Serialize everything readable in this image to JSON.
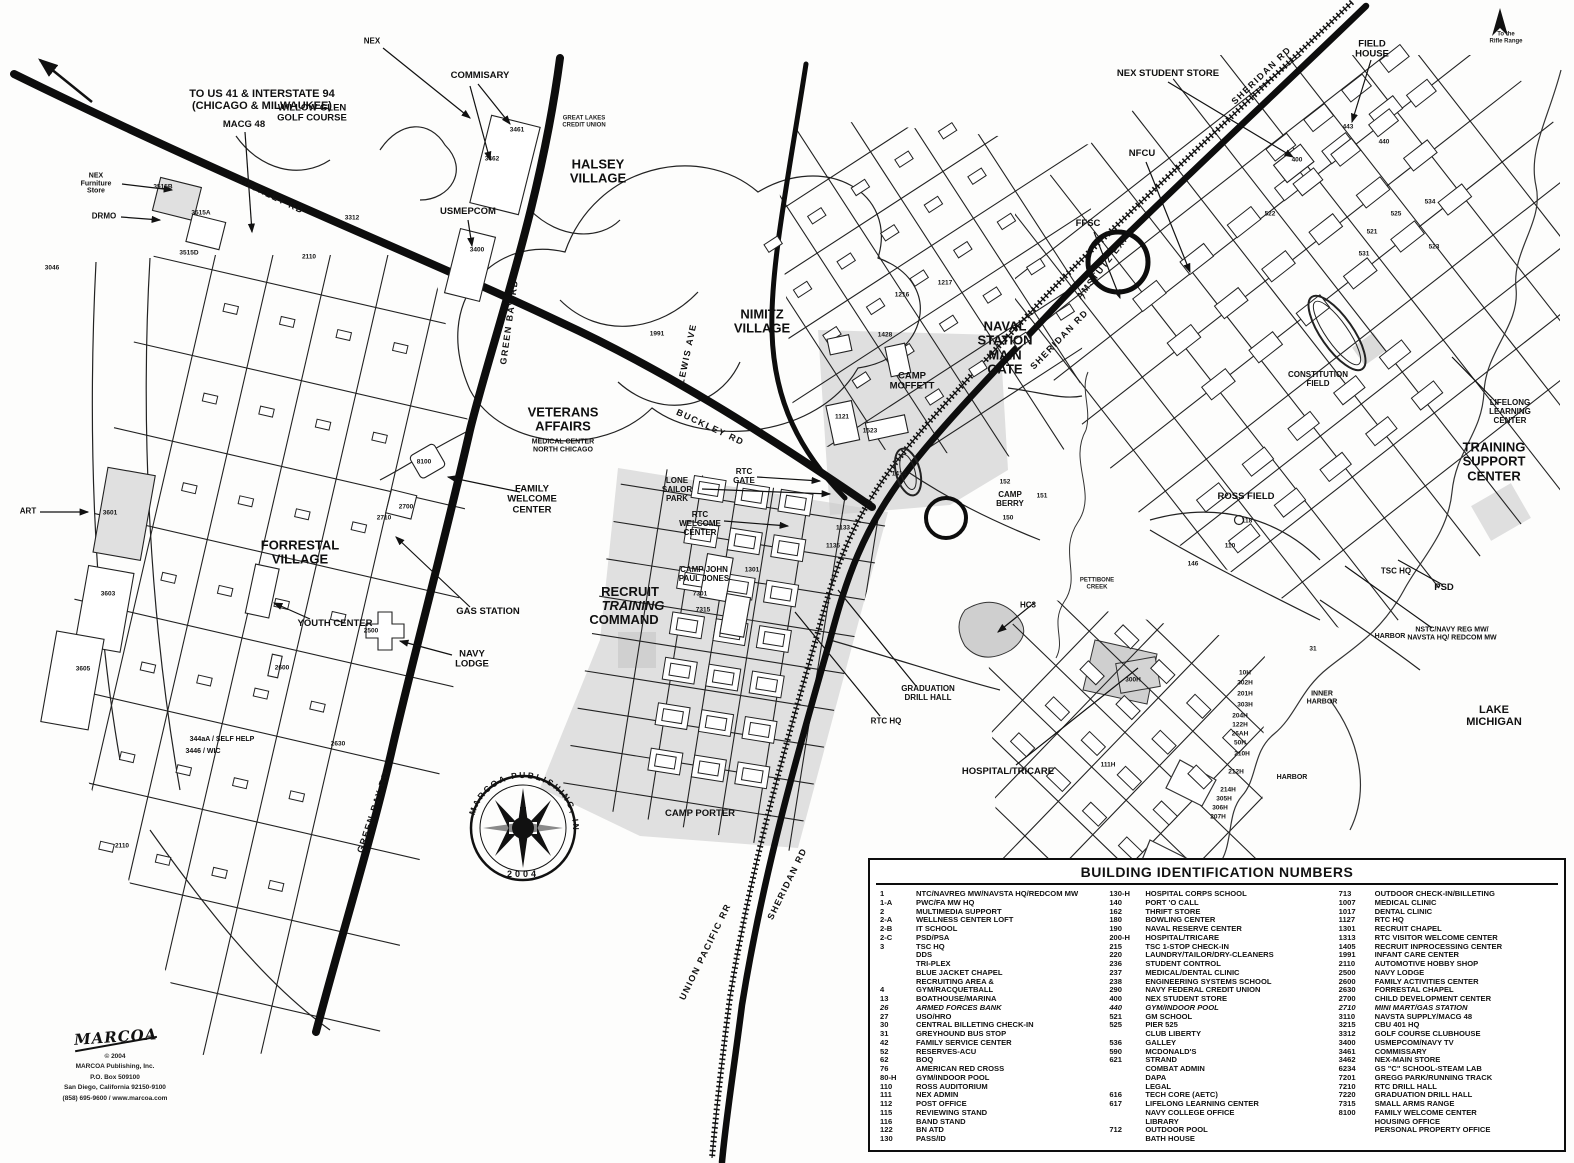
{
  "legend": {
    "title": "BUILDING IDENTIFICATION NUMBERS",
    "columns": [
      [
        {
          "n": "1",
          "t": "NTC/NAVREG MW/NAVSTA HQ/REDCOM MW"
        },
        {
          "n": "1-A",
          "t": "PWC/FA MW HQ"
        },
        {
          "n": "2",
          "t": "MULTIMEDIA SUPPORT"
        },
        {
          "n": "2-A",
          "t": "WELLNESS CENTER LOFT"
        },
        {
          "n": "2-B",
          "t": "IT SCHOOL"
        },
        {
          "n": "2-C",
          "t": "PSD/PSA"
        },
        {
          "n": "3",
          "t": "TSC HQ"
        },
        {
          "n": "",
          "t": "DDS"
        },
        {
          "n": "",
          "t": "TRI-PLEX"
        },
        {
          "n": "",
          "t": "BLUE JACKET CHAPEL"
        },
        {
          "n": "",
          "t": "RECRUITING AREA &"
        },
        {
          "n": "4",
          "t": "GYM/RACQUETBALL"
        },
        {
          "n": "13",
          "t": "BOATHOUSE/MARINA"
        },
        {
          "n": "26",
          "t": "ARMED FORCES BANK",
          "i": true
        },
        {
          "n": "27",
          "t": "USO/HRO"
        },
        {
          "n": "30",
          "t": "CENTRAL BILLETING CHECK-IN"
        },
        {
          "n": "31",
          "t": "GREYHOUND BUS STOP"
        },
        {
          "n": "42",
          "t": "FAMILY SERVICE CENTER"
        },
        {
          "n": "52",
          "t": "RESERVES-ACU"
        },
        {
          "n": "62",
          "t": "BOQ"
        },
        {
          "n": "76",
          "t": "AMERICAN RED CROSS"
        },
        {
          "n": "80-H",
          "t": "GYM/INDOOR POOL"
        },
        {
          "n": "110",
          "t": "ROSS AUDITORIUM"
        },
        {
          "n": "111",
          "t": "NEX ADMIN"
        },
        {
          "n": "112",
          "t": "POST OFFICE"
        },
        {
          "n": "115",
          "t": "REVIEWING STAND"
        },
        {
          "n": "116",
          "t": "BAND STAND"
        },
        {
          "n": "122",
          "t": "BN  ATD"
        },
        {
          "n": "130",
          "t": "PASS/ID"
        }
      ],
      [
        {
          "n": "130-H",
          "t": "HOSPITAL CORPS SCHOOL"
        },
        {
          "n": "140",
          "t": "PORT 'O CALL"
        },
        {
          "n": "162",
          "t": "THRIFT STORE"
        },
        {
          "n": "180",
          "t": "BOWLING CENTER"
        },
        {
          "n": "190",
          "t": "NAVAL RESERVE CENTER"
        },
        {
          "n": "200-H",
          "t": "HOSPITAL/TRICARE"
        },
        {
          "n": "215",
          "t": "TSC 1-STOP CHECK-IN"
        },
        {
          "n": "220",
          "t": "LAUNDRY/TAILOR/DRY-CLEANERS"
        },
        {
          "n": "236",
          "t": "STUDENT CONTROL"
        },
        {
          "n": "237",
          "t": "MEDICAL/DENTAL CLINIC"
        },
        {
          "n": "238",
          "t": "ENGINEERING SYSTEMS SCHOOL"
        },
        {
          "n": "290",
          "t": "NAVY FEDERAL CREDIT UNION"
        },
        {
          "n": "400",
          "t": "NEX STUDENT STORE"
        },
        {
          "n": "440",
          "t": "GYM/INDOOR POOL",
          "i": true
        },
        {
          "n": "521",
          "t": "GM SCHOOL"
        },
        {
          "n": "525",
          "t": "PIER 525"
        },
        {
          "n": "",
          "t": "CLUB LIBERTY"
        },
        {
          "n": "536",
          "t": "GALLEY"
        },
        {
          "n": "590",
          "t": "MCDONALD'S"
        },
        {
          "n": "621",
          "t": "STRAND"
        },
        {
          "n": "",
          "t": "COMBAT ADMIN"
        },
        {
          "n": "",
          "t": "DAPA"
        },
        {
          "n": "",
          "t": "LEGAL"
        },
        {
          "n": "616",
          "t": "TECH CORE (AETC)"
        },
        {
          "n": "617",
          "t": "LIFELONG LEARNING CENTER"
        },
        {
          "n": "",
          "t": "NAVY COLLEGE OFFICE"
        },
        {
          "n": "",
          "t": "LIBRARY"
        },
        {
          "n": "712",
          "t": "OUTDOOR POOL"
        },
        {
          "n": "",
          "t": "BATH HOUSE"
        }
      ],
      [
        {
          "n": "713",
          "t": "OUTDOOR CHECK-IN/BILLETING"
        },
        {
          "n": "1007",
          "t": "MEDICAL CLINIC"
        },
        {
          "n": "1017",
          "t": "DENTAL CLINIC"
        },
        {
          "n": "1127",
          "t": "RTC HQ"
        },
        {
          "n": "1301",
          "t": "RECRUIT CHAPEL"
        },
        {
          "n": "1313",
          "t": "RTC VISITOR WELCOME CENTER"
        },
        {
          "n": "1405",
          "t": "RECRUIT INPROCESSING CENTER"
        },
        {
          "n": "1991",
          "t": "INFANT CARE CENTER"
        },
        {
          "n": "2110",
          "t": "AUTOMOTIVE HOBBY SHOP"
        },
        {
          "n": "2500",
          "t": "NAVY LODGE"
        },
        {
          "n": "2600",
          "t": "FAMILY ACTIVITIES CENTER"
        },
        {
          "n": "2630",
          "t": "FORRESTAL CHAPEL"
        },
        {
          "n": "2700",
          "t": "CHILD DEVELOPMENT CENTER"
        },
        {
          "n": "2710",
          "t": "MINI MART/GAS STATION",
          "i": true
        },
        {
          "n": "3110",
          "t": "NAVSTA SUPPLY/MACG 48"
        },
        {
          "n": "3215",
          "t": "CBU 401 HQ"
        },
        {
          "n": "3312",
          "t": "GOLF COURSE CLUBHOUSE"
        },
        {
          "n": "3400",
          "t": "USMEPCOM/NAVY TV"
        },
        {
          "n": "3461",
          "t": "COMMISSARY"
        },
        {
          "n": "3462",
          "t": "NEX-MAIN STORE"
        },
        {
          "n": "6234",
          "t": "GS \"C\" SCHOOL-STEAM LAB"
        },
        {
          "n": "7201",
          "t": "GREGG PARK/RUNNING TRACK"
        },
        {
          "n": "7210",
          "t": "RTC DRILL HALL"
        },
        {
          "n": "7220",
          "t": "GRADUATION DRILL HALL"
        },
        {
          "n": "7315",
          "t": "SMALL ARMS RANGE"
        },
        {
          "n": "8100",
          "t": "FAMILY WELCOME CENTER"
        },
        {
          "n": "",
          "t": "HOUSING OFFICE"
        },
        {
          "n": "",
          "t": "PERSONAL PROPERTY OFFICE"
        }
      ]
    ]
  },
  "map": {
    "labels": [
      {
        "t": "TO US 41 & INTERSTATE 94\n(CHICAGO & MILWAUKEE)",
        "x": 262,
        "y": 100,
        "s": "lg"
      },
      {
        "t": "NEX",
        "x": 372,
        "y": 42,
        "s": "sm"
      },
      {
        "t": "COMMISARY",
        "x": 480,
        "y": 76,
        "s": "md"
      },
      {
        "t": "WILLOW GLEN\nGOLF COURSE",
        "x": 312,
        "y": 114,
        "s": "md"
      },
      {
        "t": "MACG 48",
        "x": 244,
        "y": 125,
        "s": "md"
      },
      {
        "t": "NEX\nFurniture\nStore",
        "x": 96,
        "y": 184,
        "s": "xs"
      },
      {
        "t": "DRMO",
        "x": 104,
        "y": 217,
        "s": "sm"
      },
      {
        "t": "HALSEY\nVILLAGE",
        "x": 598,
        "y": 172,
        "s": "xl"
      },
      {
        "t": "GREAT LAKES\nCREDIT UNION",
        "x": 584,
        "y": 122,
        "s": "xxs"
      },
      {
        "t": "USMEPCOM",
        "x": 468,
        "y": 212,
        "s": "md"
      },
      {
        "t": "NIMITZ\nVILLAGE",
        "x": 762,
        "y": 322,
        "s": "xl"
      },
      {
        "t": "VETERANS\nAFFAIRS",
        "x": 563,
        "y": 420,
        "s": "xl"
      },
      {
        "t": "MEDICAL CENTER\nNORTH CHICAGO",
        "x": 563,
        "y": 446,
        "s": "xs"
      },
      {
        "t": "CAMP\nMOFFETT",
        "x": 912,
        "y": 382,
        "s": "md"
      },
      {
        "t": "NAVAL\nSTATION\nMAIN\nGATE",
        "x": 1005,
        "y": 348,
        "s": "xl"
      },
      {
        "t": "NEX STUDENT STORE",
        "x": 1168,
        "y": 74,
        "s": "md"
      },
      {
        "t": "FIELD\nHOUSE",
        "x": 1372,
        "y": 50,
        "s": "md"
      },
      {
        "t": "NFCU",
        "x": 1142,
        "y": 154,
        "s": "md"
      },
      {
        "t": "FFSC",
        "x": 1088,
        "y": 224,
        "s": "md"
      },
      {
        "t": "AMSTUTZ EXPY",
        "x": 1106,
        "y": 264,
        "s": "road",
        "r": -52
      },
      {
        "t": "SHERIDAN RD",
        "x": 1262,
        "y": 76,
        "s": "road",
        "r": -44
      },
      {
        "t": "SHERIDAN RD",
        "x": 1060,
        "y": 340,
        "s": "road",
        "r": -46
      },
      {
        "t": "CONSTITUTION\nFIELD",
        "x": 1318,
        "y": 380,
        "s": "sm"
      },
      {
        "t": "TRAINING\nSUPPORT CENTER",
        "x": 1494,
        "y": 462,
        "s": "xl"
      },
      {
        "t": "LIFELONG\nLEARNING CENTER",
        "x": 1510,
        "y": 412,
        "s": "sm"
      },
      {
        "t": "TSC HQ",
        "x": 1396,
        "y": 572,
        "s": "sm"
      },
      {
        "t": "PSD",
        "x": 1444,
        "y": 588,
        "s": "md"
      },
      {
        "t": "NSTC/NAVY REG MW/\nNAVSTA HQ/ REDCOM MW",
        "x": 1452,
        "y": 634,
        "s": "xs"
      },
      {
        "t": "HARBOR",
        "x": 1390,
        "y": 637,
        "s": "xs"
      },
      {
        "t": "INNER\nHARBOR",
        "x": 1322,
        "y": 698,
        "s": "xs"
      },
      {
        "t": "HARBOR",
        "x": 1292,
        "y": 778,
        "s": "xs"
      },
      {
        "t": "LAKE MICHIGAN",
        "x": 1494,
        "y": 716,
        "s": "lg"
      },
      {
        "t": "PETTIBONE\nCREEK",
        "x": 1097,
        "y": 584,
        "s": "xxs"
      },
      {
        "t": "HC3",
        "x": 1028,
        "y": 606,
        "s": "sm"
      },
      {
        "t": "HOSPITAL/TRICARE",
        "x": 1008,
        "y": 772,
        "s": "md"
      },
      {
        "t": "CAMP\nBERRY",
        "x": 1010,
        "y": 500,
        "s": "sm"
      },
      {
        "t": "ROSS FIELD",
        "x": 1246,
        "y": 497,
        "s": "md"
      },
      {
        "t": "RTC\nGATE",
        "x": 744,
        "y": 477,
        "s": "sm"
      },
      {
        "t": "LONE\nSAILOR\nPARK",
        "x": 677,
        "y": 490,
        "s": "sm"
      },
      {
        "t": "RTC\nWELCOME\nCENTER",
        "x": 700,
        "y": 524,
        "s": "sm"
      },
      {
        "t": "CAMP JOHN\nPAUL JONES",
        "x": 704,
        "y": 575,
        "s": "sm"
      },
      {
        "t": "RECRUIT",
        "x": 630,
        "y": 592,
        "s": "xl"
      },
      {
        "t": "TRAINING",
        "x": 633,
        "y": 606,
        "s": "xl",
        "i": true
      },
      {
        "t": "COMMAND",
        "x": 624,
        "y": 620,
        "s": "xl"
      },
      {
        "t": "GRADUATION\nDRILL HALL",
        "x": 928,
        "y": 694,
        "s": "sm"
      },
      {
        "t": "RTC HQ",
        "x": 886,
        "y": 722,
        "s": "sm"
      },
      {
        "t": "CAMP PORTER",
        "x": 700,
        "y": 814,
        "s": "md"
      },
      {
        "t": "UNION PACIFIC RR",
        "x": 706,
        "y": 952,
        "s": "road",
        "r": -64
      },
      {
        "t": "SHERIDAN RD",
        "x": 788,
        "y": 884,
        "s": "road",
        "r": -64
      },
      {
        "t": "GREEN BAY\nRD",
        "x": 510,
        "y": 322,
        "s": "road",
        "r": -82
      },
      {
        "t": "GREEN BAY RD",
        "x": 374,
        "y": 812,
        "s": "road",
        "r": -72
      },
      {
        "t": "BUCKLEY RD",
        "x": 270,
        "y": 196,
        "s": "road",
        "r": 26
      },
      {
        "t": "BUCKLEY RD",
        "x": 710,
        "y": 428,
        "s": "road",
        "r": 25
      },
      {
        "t": "LEWIS AVE",
        "x": 688,
        "y": 354,
        "s": "road",
        "r": -78
      },
      {
        "t": "FORRESTAL\nVILLAGE",
        "x": 300,
        "y": 553,
        "s": "xl"
      },
      {
        "t": "YOUTH CENTER",
        "x": 335,
        "y": 624,
        "s": "md"
      },
      {
        "t": "GAS STATION",
        "x": 488,
        "y": 612,
        "s": "md"
      },
      {
        "t": "NAVY\nLODGE",
        "x": 472,
        "y": 660,
        "s": "md"
      },
      {
        "t": "FAMILY\nWELCOME\nCENTER",
        "x": 532,
        "y": 500,
        "s": "md"
      },
      {
        "t": "ART",
        "x": 28,
        "y": 512,
        "s": "sm"
      },
      {
        "t": "344aA / SELF HELP",
        "x": 222,
        "y": 740,
        "s": "xs"
      },
      {
        "t": "3446 / WIC",
        "x": 203,
        "y": 752,
        "s": "xs"
      },
      {
        "t": "To the\nRifle Range",
        "x": 1506,
        "y": 38,
        "s": "xxs"
      }
    ],
    "numbers": [
      {
        "t": "3515B",
        "x": 163,
        "y": 187
      },
      {
        "t": "3515A",
        "x": 201,
        "y": 213
      },
      {
        "t": "3515D",
        "x": 189,
        "y": 253
      },
      {
        "t": "3046",
        "x": 52,
        "y": 268
      },
      {
        "t": "2110",
        "x": 309,
        "y": 257
      },
      {
        "t": "3312",
        "x": 352,
        "y": 218
      },
      {
        "t": "3461",
        "x": 517,
        "y": 130
      },
      {
        "t": "3462",
        "x": 492,
        "y": 159
      },
      {
        "t": "3400",
        "x": 477,
        "y": 250
      },
      {
        "t": "1991",
        "x": 657,
        "y": 334
      },
      {
        "t": "3601",
        "x": 110,
        "y": 513
      },
      {
        "t": "3603",
        "x": 108,
        "y": 594
      },
      {
        "t": "3605",
        "x": 83,
        "y": 669
      },
      {
        "t": "2500",
        "x": 371,
        "y": 631
      },
      {
        "t": "2600",
        "x": 282,
        "y": 668
      },
      {
        "t": "2630",
        "x": 338,
        "y": 744
      },
      {
        "t": "2110",
        "x": 122,
        "y": 846
      },
      {
        "t": "8100",
        "x": 424,
        "y": 462
      },
      {
        "t": "2700",
        "x": 406,
        "y": 507
      },
      {
        "t": "2710",
        "x": 384,
        "y": 518
      },
      {
        "t": "1121",
        "x": 842,
        "y": 417
      },
      {
        "t": "1523",
        "x": 870,
        "y": 431
      },
      {
        "t": "1414",
        "x": 899,
        "y": 474
      },
      {
        "t": "1428",
        "x": 885,
        "y": 335
      },
      {
        "t": "1216",
        "x": 902,
        "y": 295
      },
      {
        "t": "1217",
        "x": 945,
        "y": 283
      },
      {
        "t": "1301",
        "x": 752,
        "y": 570
      },
      {
        "t": "7301",
        "x": 700,
        "y": 594
      },
      {
        "t": "7315",
        "x": 703,
        "y": 610
      },
      {
        "t": "1133",
        "x": 843,
        "y": 528
      },
      {
        "t": "1135",
        "x": 833,
        "y": 546
      },
      {
        "t": "400",
        "x": 1297,
        "y": 160
      },
      {
        "t": "440",
        "x": 1384,
        "y": 142
      },
      {
        "t": "443",
        "x": 1348,
        "y": 127
      },
      {
        "t": "522",
        "x": 1270,
        "y": 214
      },
      {
        "t": "525",
        "x": 1396,
        "y": 214
      },
      {
        "t": "521",
        "x": 1372,
        "y": 232
      },
      {
        "t": "534",
        "x": 1430,
        "y": 202
      },
      {
        "t": "523",
        "x": 1434,
        "y": 247
      },
      {
        "t": "531",
        "x": 1364,
        "y": 254
      },
      {
        "t": "118",
        "x": 1247,
        "y": 521
      },
      {
        "t": "110",
        "x": 1230,
        "y": 546
      },
      {
        "t": "146",
        "x": 1193,
        "y": 564
      },
      {
        "t": "300H",
        "x": 1133,
        "y": 680
      },
      {
        "t": "111H",
        "x": 1108,
        "y": 765
      },
      {
        "t": "31",
        "x": 1313,
        "y": 649
      },
      {
        "t": "152",
        "x": 1005,
        "y": 482
      },
      {
        "t": "151",
        "x": 1042,
        "y": 496
      },
      {
        "t": "150",
        "x": 1008,
        "y": 518
      },
      {
        "t": "10H",
        "x": 1245,
        "y": 673
      },
      {
        "t": "302H",
        "x": 1245,
        "y": 683
      },
      {
        "t": "201H",
        "x": 1245,
        "y": 694
      },
      {
        "t": "303H",
        "x": 1245,
        "y": 705
      },
      {
        "t": "204H",
        "x": 1240,
        "y": 716
      },
      {
        "t": "122H",
        "x": 1240,
        "y": 725
      },
      {
        "t": "26AH",
        "x": 1240,
        "y": 734
      },
      {
        "t": "50H",
        "x": 1240,
        "y": 743
      },
      {
        "t": "210H",
        "x": 1242,
        "y": 754
      },
      {
        "t": "212H",
        "x": 1236,
        "y": 772
      },
      {
        "t": "214H",
        "x": 1228,
        "y": 790
      },
      {
        "t": "305H",
        "x": 1224,
        "y": 799
      },
      {
        "t": "306H",
        "x": 1220,
        "y": 808
      },
      {
        "t": "207H",
        "x": 1218,
        "y": 817
      }
    ]
  },
  "publisher": {
    "compass_text": "MARCOA  PUBLISHING,  INC.",
    "compass_year": "2004",
    "compass_n": "N",
    "logo_text": "MARCOA",
    "credits": [
      "© 2004",
      "MARCOA Publishing, Inc.",
      "P.O. Box 509100",
      "San Diego, California 92150-9100",
      "(858) 695-9600 / www.marcoa.com"
    ]
  }
}
